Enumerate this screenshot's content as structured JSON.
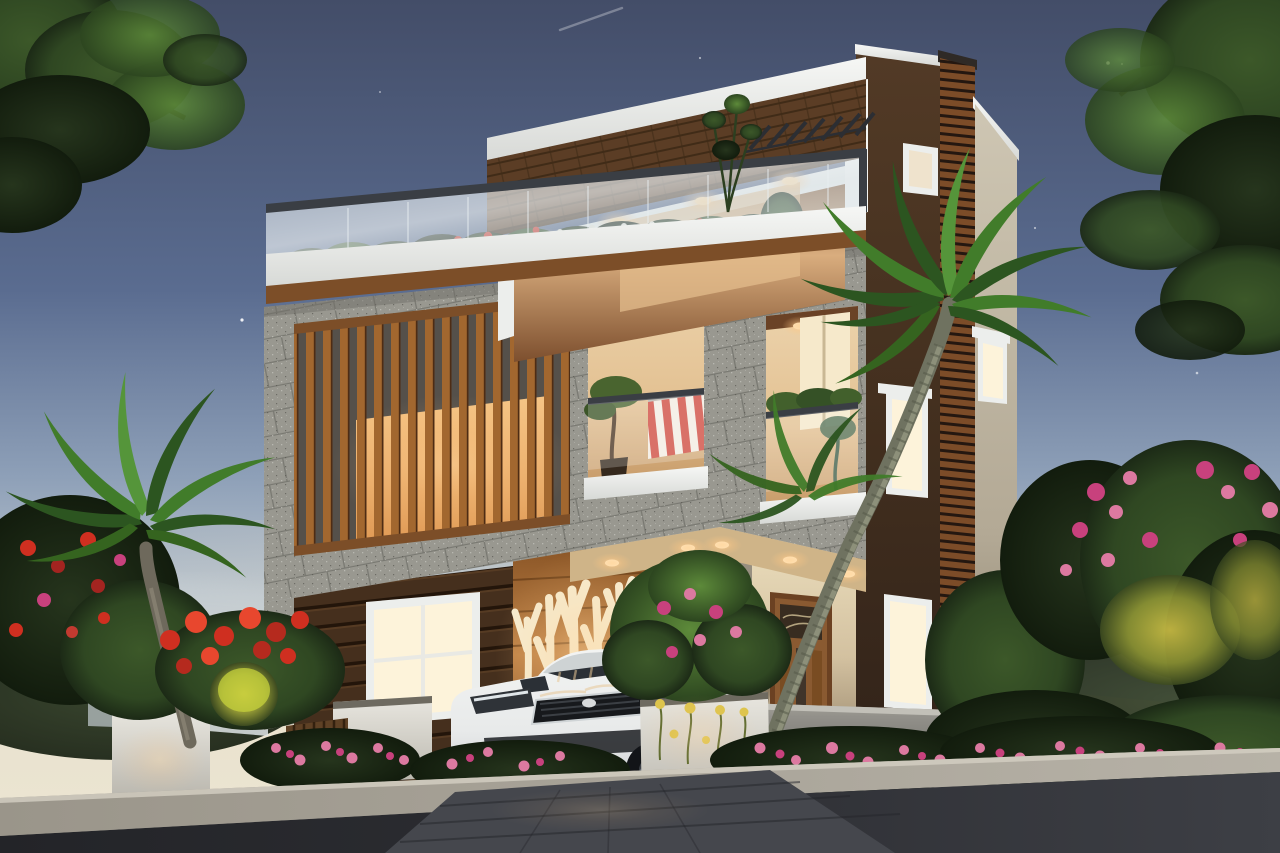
{
  "scene": {
    "alt": "Dusk 3D exterior rendering of a modern three-storey house with a rooftop glass-railing terrace, brick fascia, granite-clad balcony frame, vertical timber slat screen, glowing tree-motif feature wall, wooden front door, palm trees, flowering shrubs, white planters and a white sedan parked on the driveway",
    "objects": [
      "dusk-sky",
      "stars",
      "jet-contrail",
      "street-tree-left",
      "street-tree-right",
      "three-storey-house",
      "rooftop-terrace",
      "glass-railing",
      "terrace-garden",
      "pergola-rafters",
      "brick-fascia",
      "granite-cladding",
      "timber-slat-screen",
      "balcony-opening-left",
      "balcony-opening-right",
      "striped-awning",
      "balcony-plants",
      "porch",
      "porch-column",
      "tree-motif-feature-wall",
      "wood-plank-siding",
      "lit-windows",
      "wooden-front-door",
      "timber-louver-fin",
      "cream-side-wall",
      "compound-wall",
      "white-planters",
      "garden-fence",
      "palm-tree-left",
      "palm-tree-right",
      "red-flowering-shrubs",
      "pink-flower-bed",
      "yellow-flowers",
      "uplit-shrub",
      "white-sedan",
      "paved-driveway",
      "kerb",
      "asphalt-road",
      "distant-houses"
    ]
  },
  "palette": {
    "sky_top": "#434d68",
    "sky_mid": "#5a6c90",
    "sky_low": "#8ea0b8",
    "sky_horizon": "#e9e2cf",
    "foliage_dark": "#1c2a16",
    "foliage_mid": "#2f4722",
    "foliage_light": "#5d8a3a",
    "brick": "#5b3d25",
    "white_trim": "#eceeec",
    "glass_tint": "#cfdbe2",
    "rail_dark": "#3a3e44",
    "wood_trim": "#7c4e28",
    "slat_wood": "#a2672f",
    "granite": "#999890",
    "granite_line": "#63625c",
    "interior_warm": "#d9ad7e",
    "window_glow": "#fdf3da",
    "warm_light": "#ffd9a2",
    "siding": "#452f1d",
    "treewall_bg": "#c08448",
    "treewall_branch": "#f6ecd0",
    "cream_wall": "#cec6b3",
    "brown_wall": "#44301f",
    "door_wood": "#8a5a31",
    "compound_wall": "#92908a",
    "planter": "#e9e7e0",
    "car_body": "#f3f4f3",
    "car_glass": "#2b3036",
    "flower_red": "#cf2f20",
    "flower_magenta": "#c8417d",
    "flower_pink": "#dc79a0",
    "flower_yellow": "#ddc44c",
    "palm_trunk": "#7d7f6d",
    "palm_frond": "#3a6b28",
    "curb": "#b7b2a7",
    "road": "#2d2e33",
    "driveway": "#45474d"
  }
}
